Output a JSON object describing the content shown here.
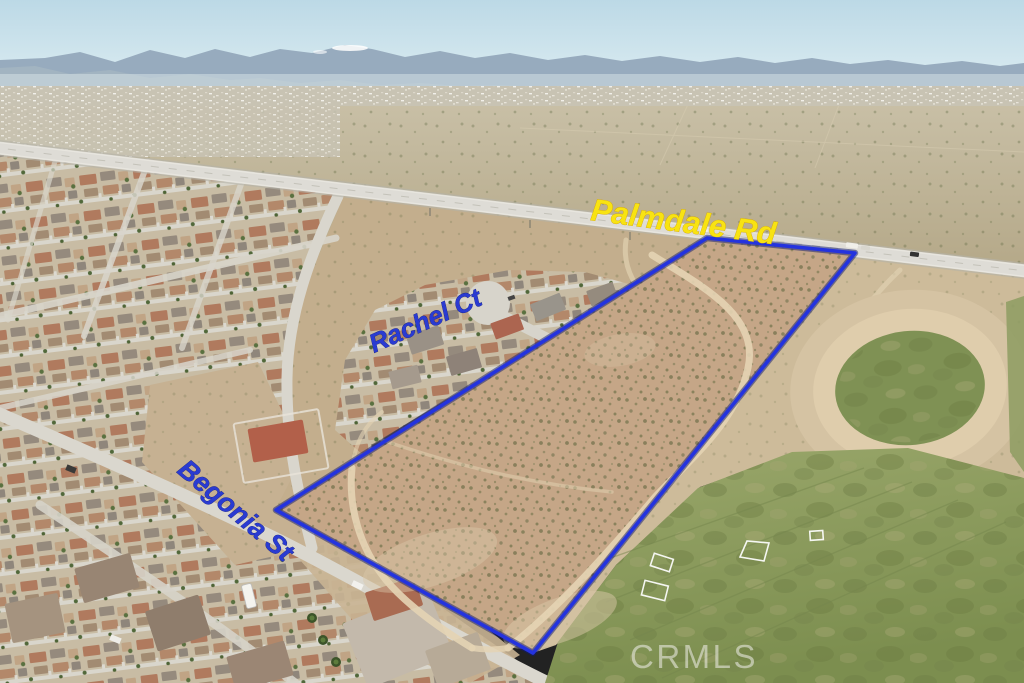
{
  "image": {
    "kind": "aerial-drone-photo",
    "description": "Aerial photo of a vacant desert parcel outlined in blue, bordered by Palmdale Rd, Rachel Ct and Begonia St, with a residential neighborhood, a dirt oval and a grass sports field"
  },
  "annotations": {
    "road_label": "Palmdale Rd",
    "court_label": "Rachel Ct",
    "street_label": "Begonia St"
  },
  "watermark": {
    "text": "CRMLS"
  },
  "colors": {
    "road_label_fill": "#f8e312",
    "street_label_fill": "#2a3bd2",
    "boundary_stroke": "#2433de",
    "watermark_fill": "#f2f1ec"
  }
}
